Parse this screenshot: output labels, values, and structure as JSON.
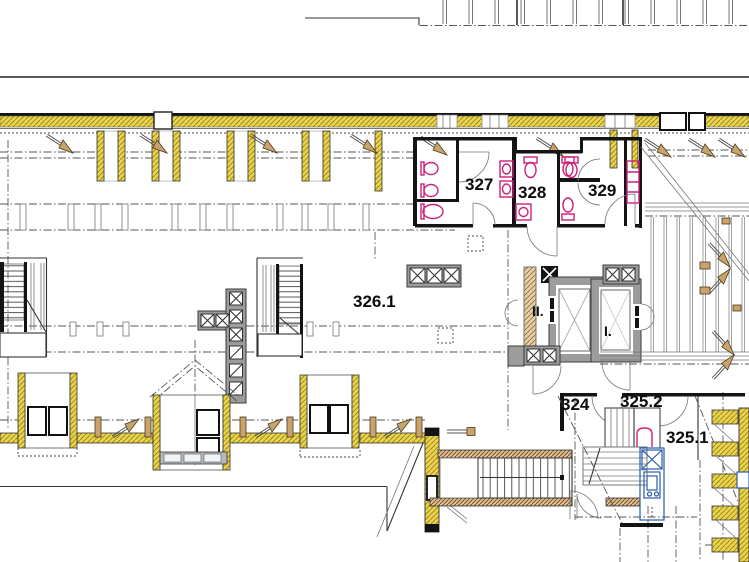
{
  "plan": {
    "rooms": {
      "r327": "327",
      "r328": "328",
      "r329": "329",
      "r326_1": "326.1",
      "r324": "324",
      "r325_2": "325.2",
      "r325_1": "325.1"
    },
    "elevators": {
      "elev2": "II.",
      "elev1": "I."
    },
    "colors": {
      "insulation_yellow": "#e9d44a",
      "wood_tan": "#c9a36b",
      "shaft_gray": "#9c9c9c",
      "fixture_magenta": "#cf2079",
      "hw_blue": "#2a5caa",
      "line_dark": "#1a1a1a"
    }
  }
}
